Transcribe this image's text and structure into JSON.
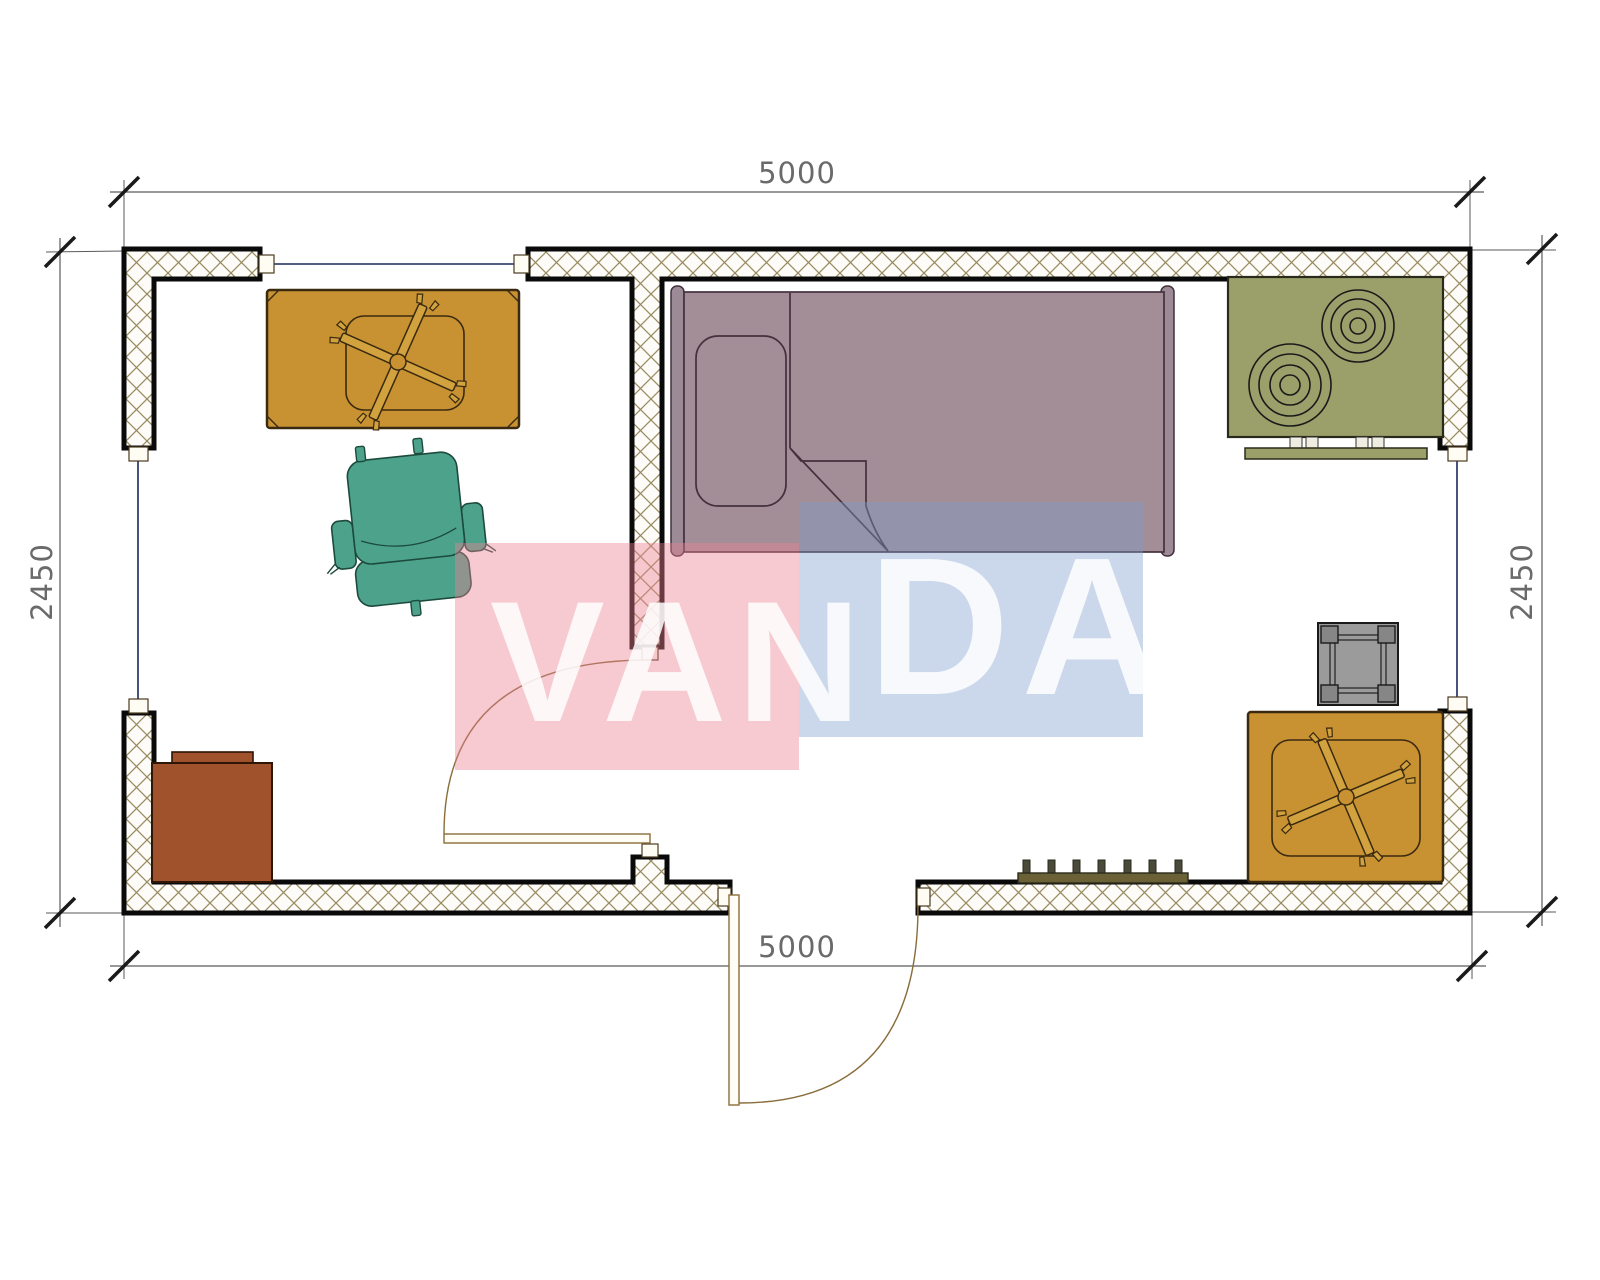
{
  "title": "Container house floor plan 5000 x 2450",
  "dimensions": {
    "top": "5000",
    "bottom": "5000",
    "left": "2450",
    "right": "2450"
  },
  "watermark": {
    "text_left": "VAN",
    "text_right": "DA",
    "pink_block_color": "rgba(236,128,148,0.42)",
    "blue_block_color": "rgba(125,158,205,0.40)",
    "pink_hex": "#f5cdd3",
    "blue_hex": "#cfdbee",
    "letter_color": "#ffffff"
  },
  "colors": {
    "wall_outline": "#0a0a0a",
    "wall_hatch": "#9a8c62",
    "dimension_line": "#5a5a5a",
    "dimension_text": "#6a6a6a",
    "glazing": "#1a2a5a",
    "door": "#8a6d3b",
    "table": "#c89232",
    "table_inner": "#d2a23e",
    "chair": "#4da28c",
    "bed": "#a38d97",
    "bed_board": "#9c8b96",
    "stove": "#9ba06b",
    "stove_rail": "#9ba06b",
    "cabinet": "#a0522d",
    "stool": "#9b9b9b",
    "stool_leg": "#868686",
    "radiator": "#6b6136",
    "radiator_tick": "#4a4a3a"
  },
  "furniture": [
    "table-with-fan-top-left",
    "office-chair",
    "single-bed",
    "stove-two-burners",
    "kitchen-rail",
    "square-stool",
    "table-with-fan-bottom-right",
    "cabinet",
    "radiator"
  ],
  "openings": [
    "window-top",
    "window-left",
    "window-right",
    "interior-door",
    "exterior-door"
  ]
}
